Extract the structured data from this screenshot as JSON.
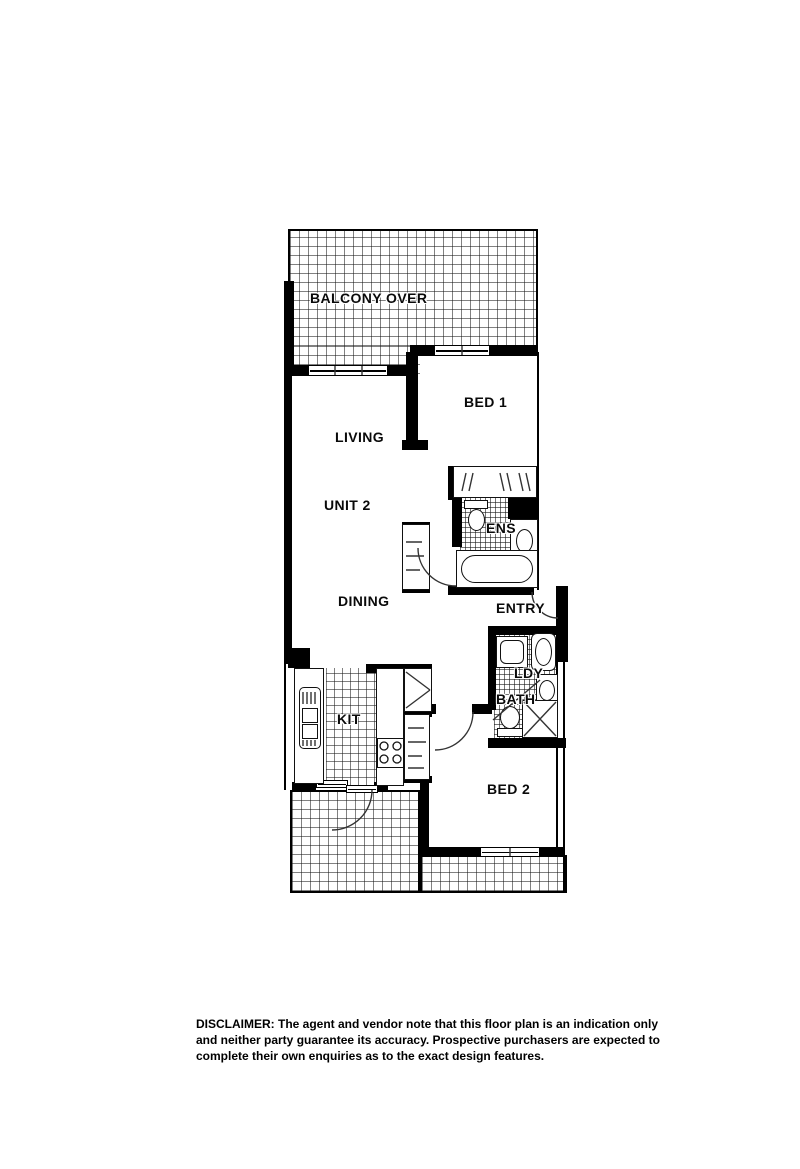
{
  "floor_plan": {
    "unit_label": "UNIT 2",
    "rooms": {
      "balcony": "BALCONY OVER",
      "bed1": "BED 1",
      "living": "LIVING",
      "dining": "DINING",
      "ens": "ENS",
      "entry": "ENTRY",
      "ldy": "LDY",
      "bath": "BATH",
      "kit": "KIT",
      "bed2": "BED 2"
    },
    "icons": [
      "toilet-icon",
      "bathtub-icon",
      "shower-icon",
      "basin-icon",
      "washing-machine-icon",
      "laundry-trough-icon",
      "kitchen-sink-icon",
      "cooktop-icon",
      "wardrobe-icon",
      "pantry-icon",
      "linen-cupboard-icon",
      "door-swing-icon",
      "window-icon"
    ],
    "colors": {
      "wall": "#000000",
      "paper": "#ffffff",
      "line": "#333333"
    }
  },
  "disclaimer": {
    "lines": [
      "DISCLAIMER: The agent and vendor note that this floor plan is an indication only",
      "and neither party guarantee its accuracy. Prospective purchasers are expected to",
      "complete their own enquiries as to the exact design features."
    ]
  }
}
